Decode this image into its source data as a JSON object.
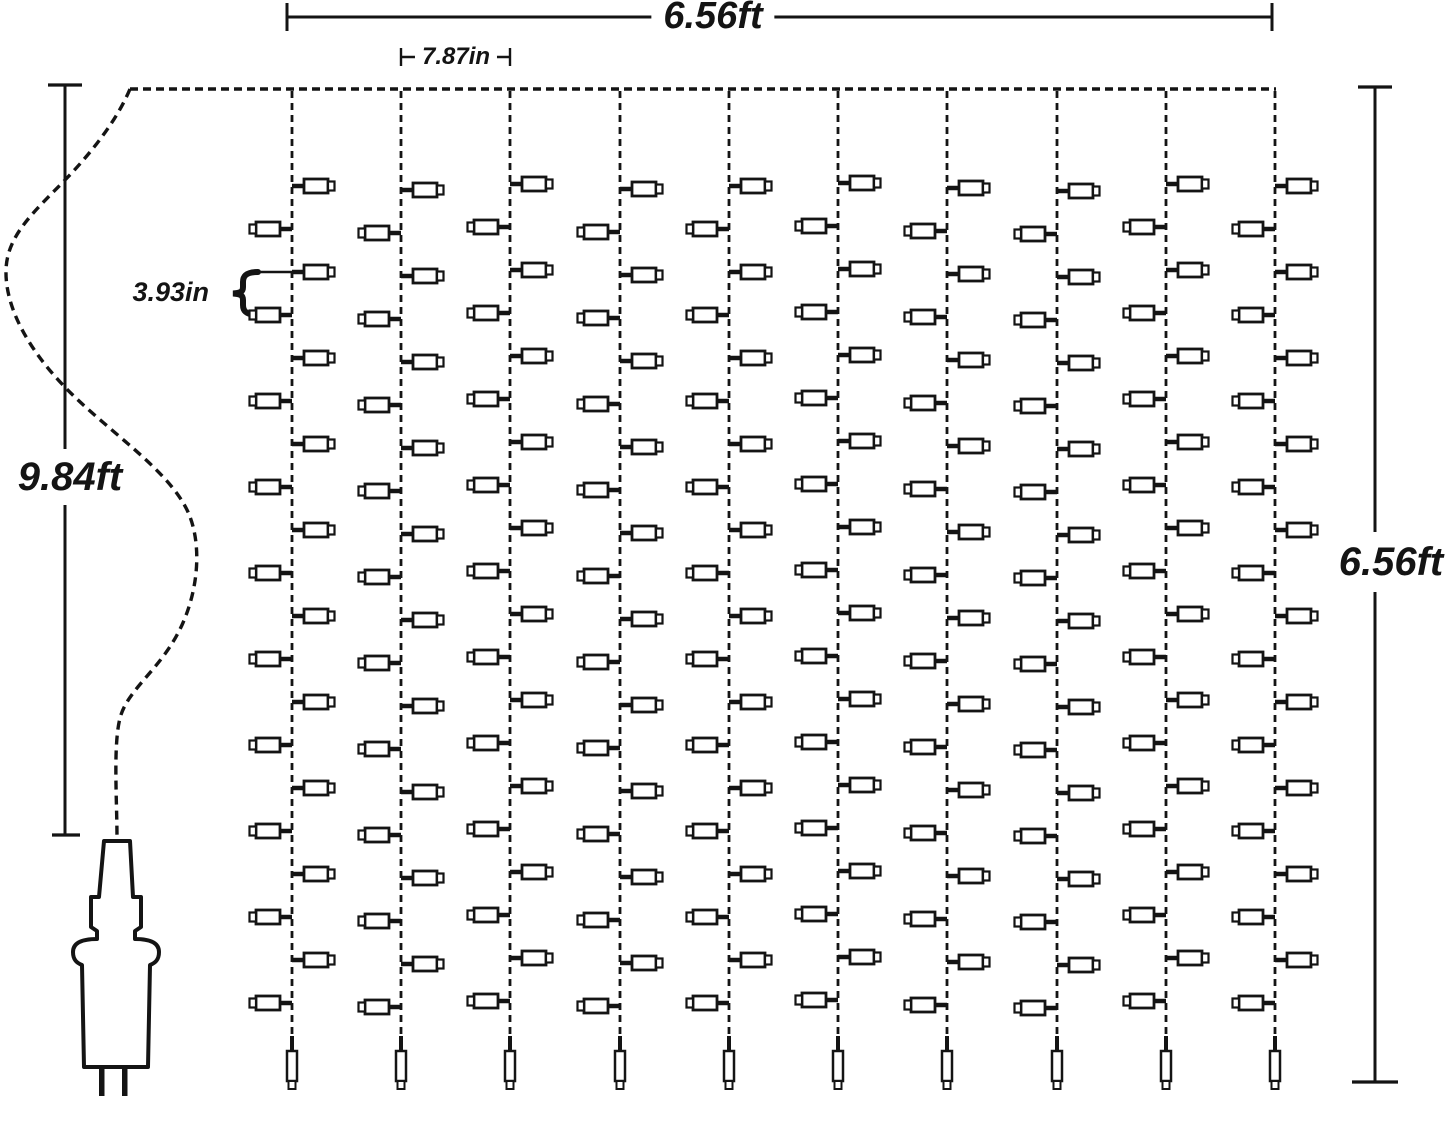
{
  "diagram": {
    "type": "product-dimension-diagram",
    "subject": "LED curtain string lights with two-prong power plug",
    "background": "#ffffff",
    "ink": "#141414"
  },
  "dimensions": {
    "curtain_width": "6.56ft",
    "strand_spacing": "7.87in",
    "bulb_spacing": "3.93in",
    "lead_wire_length": "9.84ft",
    "curtain_height": "6.56ft"
  },
  "structure": {
    "strand_count": 10,
    "bulbs_per_strand": 20,
    "end_bulbs_per_strand": 1,
    "plug_prongs": 2
  }
}
